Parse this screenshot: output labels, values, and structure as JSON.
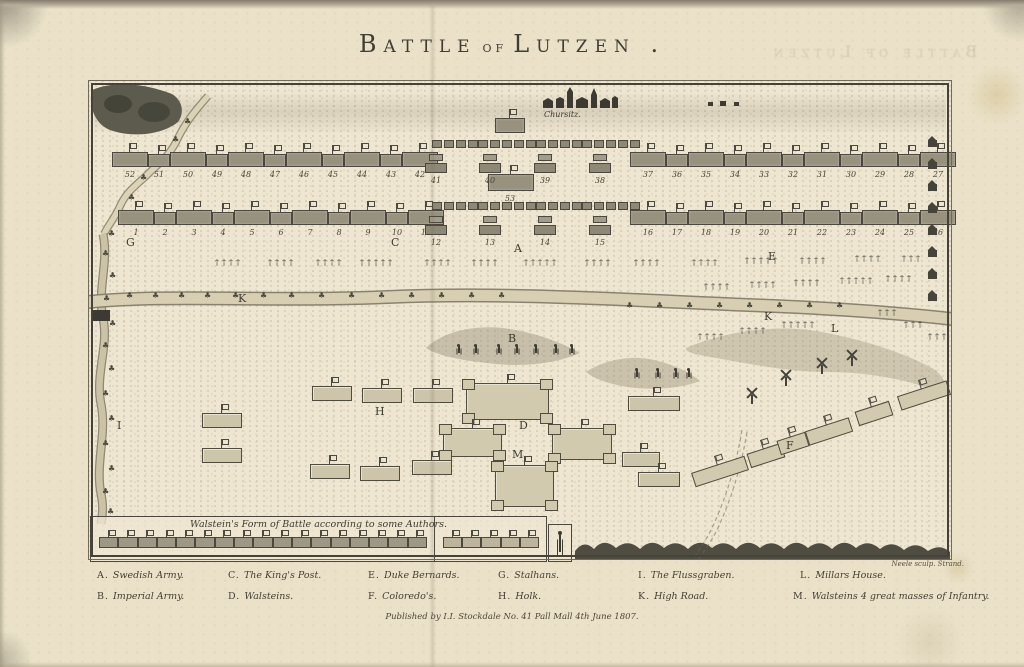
{
  "page": {
    "title": {
      "w1": "Battle",
      "w2": "of",
      "w3": "Lutzen ."
    },
    "ghost_title": "Battle of Lutzen",
    "imprint": "Published by I.I. Stockdale No. 41 Pall Mall 4th June 1807.",
    "engraver": "Neele sculp. Strand."
  },
  "map": {
    "village": "Chursitz.",
    "inset": {
      "title": "Walstein's Form of Battle according to some Authors.",
      "left_count": 17,
      "right_count": 5
    },
    "line_sections": [
      {
        "id": "imperial-left",
        "x": 24,
        "y": 62,
        "w": 316,
        "nums": [
          "52",
          "51",
          "50",
          "49",
          "48",
          "47",
          "46",
          "45",
          "44",
          "43",
          "42"
        ]
      },
      {
        "id": "imperial-right",
        "x": 542,
        "y": 62,
        "w": 294,
        "nums": [
          "37",
          "36",
          "35",
          "34",
          "33",
          "32",
          "31",
          "30",
          "29",
          "28",
          "27"
        ]
      },
      {
        "id": "swedish-left",
        "x": 30,
        "y": 120,
        "w": 324,
        "nums": [
          "1",
          "2",
          "3",
          "4",
          "5",
          "6",
          "7",
          "8",
          "9",
          "10",
          "11"
        ]
      },
      {
        "id": "swedish-right",
        "x": 542,
        "y": 120,
        "w": 294,
        "nums": [
          "16",
          "17",
          "18",
          "19",
          "20",
          "21",
          "22",
          "23",
          "24",
          "25",
          "26"
        ]
      }
    ],
    "center_sections": [
      {
        "id": "imperial-center",
        "sq_y": 60,
        "sq_counts": [
          4,
          5,
          4,
          5
        ],
        "pair_y": 74,
        "pair_xs": [
          348,
          402,
          457,
          512
        ],
        "nums": [
          "41",
          "40",
          "39",
          "38"
        ]
      },
      {
        "id": "swedish-center",
        "sq_y": 122,
        "sq_counts": [
          4,
          5,
          4,
          5
        ],
        "pair_y": 136,
        "pair_xs": [
          348,
          402,
          457,
          512
        ],
        "nums": [
          "12",
          "13",
          "14",
          "15"
        ]
      }
    ],
    "reserve": {
      "label": "53",
      "x": 400,
      "y": 94,
      "w": 44,
      "h": 15
    },
    "misc_blocks": [
      {
        "x": 407,
        "y": 38,
        "w": 28
      }
    ],
    "letters": [
      {
        "k": "G",
        "x": 38,
        "y": 156
      },
      {
        "k": "C",
        "x": 303,
        "y": 156
      },
      {
        "k": "A",
        "x": 426,
        "y": 162
      },
      {
        "k": "E",
        "x": 680,
        "y": 170
      },
      {
        "k": "K",
        "x": 150,
        "y": 212
      },
      {
        "k": "K",
        "x": 676,
        "y": 230
      },
      {
        "k": "L",
        "x": 743,
        "y": 242
      },
      {
        "k": "B",
        "x": 420,
        "y": 252
      },
      {
        "k": "D",
        "x": 431,
        "y": 339
      },
      {
        "k": "M",
        "x": 424,
        "y": 368
      },
      {
        "k": "H",
        "x": 287,
        "y": 325
      },
      {
        "k": "F",
        "x": 698,
        "y": 359
      },
      {
        "k": "I",
        "x": 29,
        "y": 339
      }
    ],
    "bastions": [
      {
        "x": 378,
        "y": 303,
        "w": 81,
        "h": 35
      },
      {
        "x": 355,
        "y": 348,
        "w": 57,
        "h": 27
      },
      {
        "x": 464,
        "y": 348,
        "w": 58,
        "h": 30
      },
      {
        "x": 407,
        "y": 385,
        "w": 57,
        "h": 40
      }
    ],
    "hblocks": [
      {
        "x": 224,
        "y": 306,
        "w": 38
      },
      {
        "x": 274,
        "y": 308,
        "w": 38
      },
      {
        "x": 325,
        "y": 308,
        "w": 38
      },
      {
        "x": 114,
        "y": 333,
        "w": 38
      },
      {
        "x": 114,
        "y": 368,
        "w": 38
      },
      {
        "x": 222,
        "y": 384,
        "w": 38
      },
      {
        "x": 272,
        "y": 386,
        "w": 38
      },
      {
        "x": 324,
        "y": 380,
        "w": 38
      },
      {
        "x": 540,
        "y": 316,
        "w": 50
      },
      {
        "x": 534,
        "y": 372,
        "w": 36
      },
      {
        "x": 550,
        "y": 392,
        "w": 40
      }
    ],
    "fblocks": [
      {
        "x": 604,
        "y": 384,
        "w": 54
      },
      {
        "x": 660,
        "y": 368,
        "w": 34
      },
      {
        "x": 690,
        "y": 356,
        "w": 28
      },
      {
        "x": 718,
        "y": 344,
        "w": 44
      },
      {
        "x": 768,
        "y": 326,
        "w": 34
      },
      {
        "x": 810,
        "y": 308,
        "w": 50
      }
    ],
    "windmills": [
      {
        "x": 656,
        "y": 306
      },
      {
        "x": 690,
        "y": 288
      },
      {
        "x": 726,
        "y": 276
      },
      {
        "x": 756,
        "y": 268
      }
    ],
    "figures": [
      {
        "y": 264,
        "xs": [
          367,
          384,
          407,
          425,
          444,
          464,
          480
        ]
      },
      {
        "y": 288,
        "xs": [
          545,
          566,
          584,
          597
        ]
      }
    ],
    "trees": [
      {
        "x": 127,
        "y": 178,
        "n": 4
      },
      {
        "x": 180,
        "y": 178,
        "n": 4
      },
      {
        "x": 228,
        "y": 178,
        "n": 4
      },
      {
        "x": 272,
        "y": 178,
        "n": 5
      },
      {
        "x": 337,
        "y": 178,
        "n": 4
      },
      {
        "x": 384,
        "y": 178,
        "n": 4
      },
      {
        "x": 436,
        "y": 178,
        "n": 5
      },
      {
        "x": 497,
        "y": 178,
        "n": 4
      },
      {
        "x": 546,
        "y": 178,
        "n": 4
      },
      {
        "x": 604,
        "y": 178,
        "n": 4
      },
      {
        "x": 657,
        "y": 176,
        "n": 5
      },
      {
        "x": 712,
        "y": 176,
        "n": 4
      },
      {
        "x": 767,
        "y": 174,
        "n": 4
      },
      {
        "x": 814,
        "y": 174,
        "n": 3
      },
      {
        "x": 616,
        "y": 202,
        "n": 4
      },
      {
        "x": 662,
        "y": 200,
        "n": 4
      },
      {
        "x": 706,
        "y": 198,
        "n": 4
      },
      {
        "x": 752,
        "y": 196,
        "n": 5
      },
      {
        "x": 798,
        "y": 194,
        "n": 4
      },
      {
        "x": 610,
        "y": 252,
        "n": 4
      },
      {
        "x": 652,
        "y": 246,
        "n": 4
      },
      {
        "x": 694,
        "y": 240,
        "n": 5
      },
      {
        "x": 790,
        "y": 228,
        "n": 3
      },
      {
        "x": 816,
        "y": 240,
        "n": 3
      },
      {
        "x": 840,
        "y": 252,
        "n": 3
      }
    ],
    "bushes": [
      [
        20,
        150
      ],
      [
        14,
        170
      ],
      [
        21,
        192
      ],
      [
        15,
        215
      ],
      [
        21,
        240
      ],
      [
        14,
        262
      ],
      [
        20,
        285
      ],
      [
        14,
        310
      ],
      [
        20,
        335
      ],
      [
        14,
        360
      ],
      [
        20,
        385
      ],
      [
        14,
        408
      ],
      [
        19,
        428
      ],
      [
        38,
        212
      ],
      [
        64,
        212
      ],
      [
        90,
        212
      ],
      [
        116,
        212
      ],
      [
        144,
        212
      ],
      [
        172,
        212
      ],
      [
        200,
        212
      ],
      [
        230,
        212
      ],
      [
        260,
        212
      ],
      [
        290,
        212
      ],
      [
        320,
        212
      ],
      [
        350,
        212
      ],
      [
        380,
        212
      ],
      [
        410,
        212
      ],
      [
        538,
        222
      ],
      [
        568,
        222
      ],
      [
        598,
        222
      ],
      [
        628,
        222
      ],
      [
        658,
        222
      ],
      [
        688,
        222
      ],
      [
        718,
        222
      ],
      [
        748,
        222
      ],
      [
        96,
        38
      ],
      [
        84,
        56
      ],
      [
        68,
        74
      ],
      [
        52,
        94
      ],
      [
        40,
        114
      ],
      [
        30,
        134
      ]
    ],
    "town_houses": {
      "x": 840,
      "ys": [
        60,
        82,
        104,
        126,
        148,
        170,
        192,
        214
      ]
    }
  },
  "legend": {
    "row_y": [
      570,
      591
    ],
    "entries": [
      {
        "key": "A",
        "name": "Swedish Army.",
        "x": 97,
        "row": 0
      },
      {
        "key": "C",
        "name": "The King's Post.",
        "x": 228,
        "row": 0
      },
      {
        "key": "E",
        "name": "Duke Bernards.",
        "x": 368,
        "row": 0
      },
      {
        "key": "G",
        "name": "Stalhans.",
        "x": 498,
        "row": 0
      },
      {
        "key": "I",
        "name": "The Flussgraben.",
        "x": 638,
        "row": 0
      },
      {
        "key": "L",
        "name": "Millars House.",
        "x": 800,
        "row": 0
      },
      {
        "key": "B",
        "name": "Imperial Army.",
        "x": 97,
        "row": 1
      },
      {
        "key": "D",
        "name": "Walsteins.",
        "x": 228,
        "row": 1
      },
      {
        "key": "F",
        "name": "Coloredo's.",
        "x": 368,
        "row": 1
      },
      {
        "key": "H",
        "name": "Holk.",
        "x": 498,
        "row": 1
      },
      {
        "key": "K",
        "name": "High Road.",
        "x": 638,
        "row": 1
      },
      {
        "key": "M",
        "name": "Walsteins 4 great masses of Infantry.",
        "x": 793,
        "row": 1
      }
    ]
  }
}
